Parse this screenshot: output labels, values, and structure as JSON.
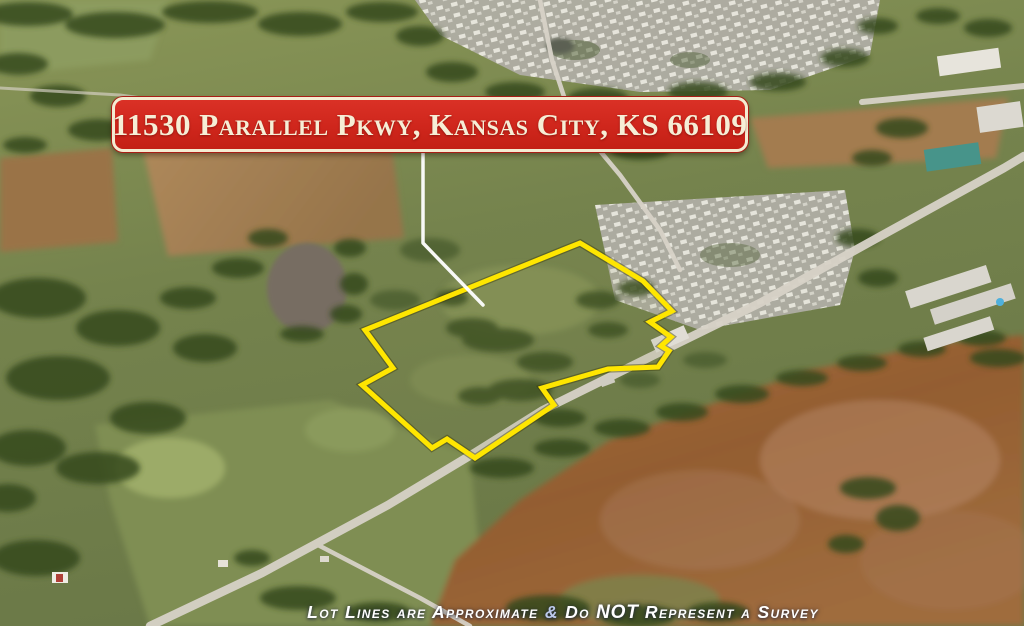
{
  "banner": {
    "address": "11530 Parallel Pkwy, Kansas City, KS 66109",
    "bg_color": "#cf261c",
    "border_color": "#f4ecd2",
    "text_color": "#f6eed6"
  },
  "disclaimer": {
    "part1": "Lot Lines are Approximate ",
    "ampersand": "&",
    "part2": " Do ",
    "not_word": "NOT",
    "part3": " Represent a Survey",
    "text_color": "#ffffff",
    "ampersand_color": "#bcc9ea"
  },
  "map": {
    "type": "aerial-photo",
    "property_outline": {
      "color": "#ffe600",
      "points": "580,243 643,281 672,311 650,322 671,337 661,346 669,351 658,367 608,369 542,388 554,405 475,458 447,439 432,448 362,385 393,368 365,330"
    },
    "pointer_line": {
      "color": "#ffffff",
      "points": "423,152 423,243 483,305"
    }
  }
}
